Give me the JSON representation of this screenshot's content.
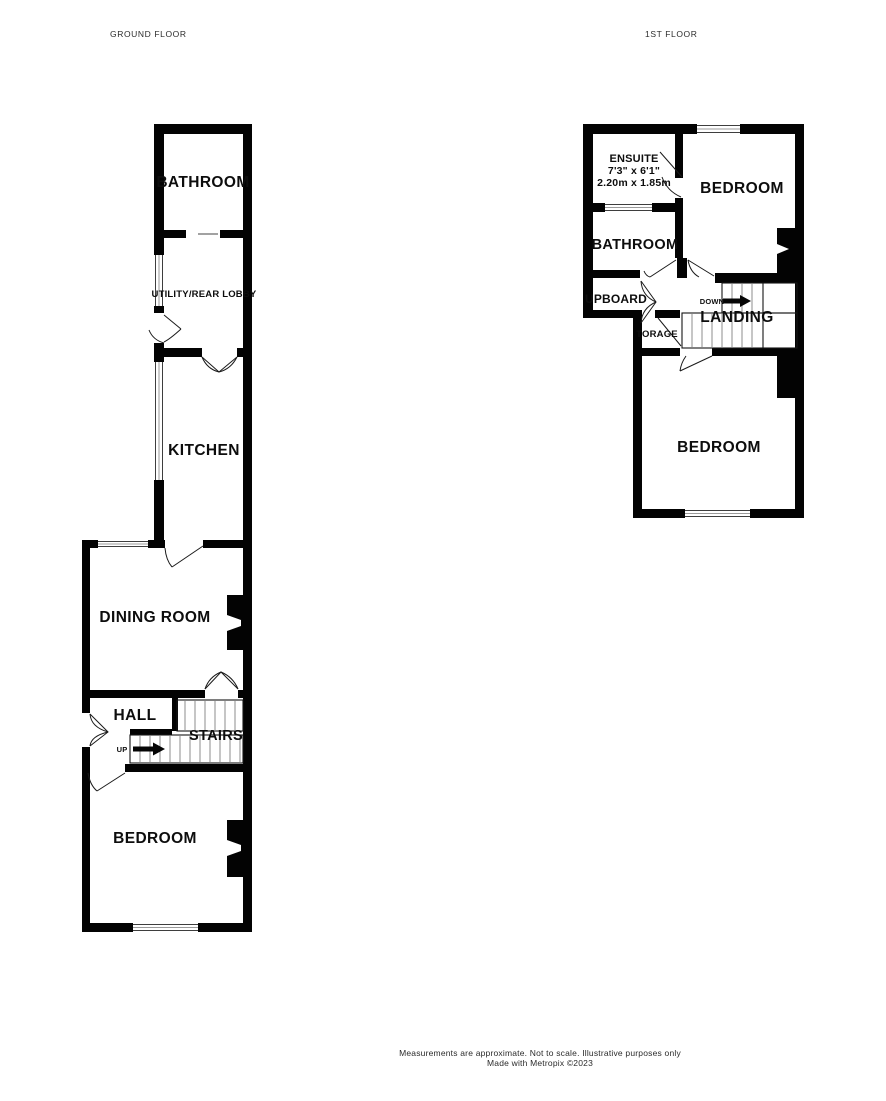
{
  "titles": {
    "ground_floor": "GROUND FLOOR",
    "first_floor": "1ST FLOOR"
  },
  "ground_floor": {
    "bathroom": "BATHROOM",
    "utility": "UTILITY/REAR LOBBY",
    "kitchen": "KITCHEN",
    "dining_room": "DINING ROOM",
    "hall": "HALL",
    "stairs": "STAIRS",
    "up": "UP",
    "bedroom": "BEDROOM"
  },
  "first_floor": {
    "ensuite": "ENSUITE",
    "ensuite_size_imperial": "7'3\"  x 6'1\"",
    "ensuite_size_metric": "2.20m  x 1.85m",
    "bedroom_front": "BEDROOM",
    "bathroom": "BATHROOM",
    "cupboard": "UPBOARD",
    "down": "DOWN",
    "landing": "LANDING",
    "storage": "TORAGE",
    "bedroom_rear": "BEDROOM"
  },
  "footer": {
    "disclaimer": "Measurements are approximate.  Not to scale.  Illustrative purposes only",
    "credit": "Made with Metropix ©2023"
  },
  "colors": {
    "background": "#ffffff",
    "wall": "#000000",
    "window_line": "#999999",
    "stair_tread": "#8c8c8c"
  }
}
